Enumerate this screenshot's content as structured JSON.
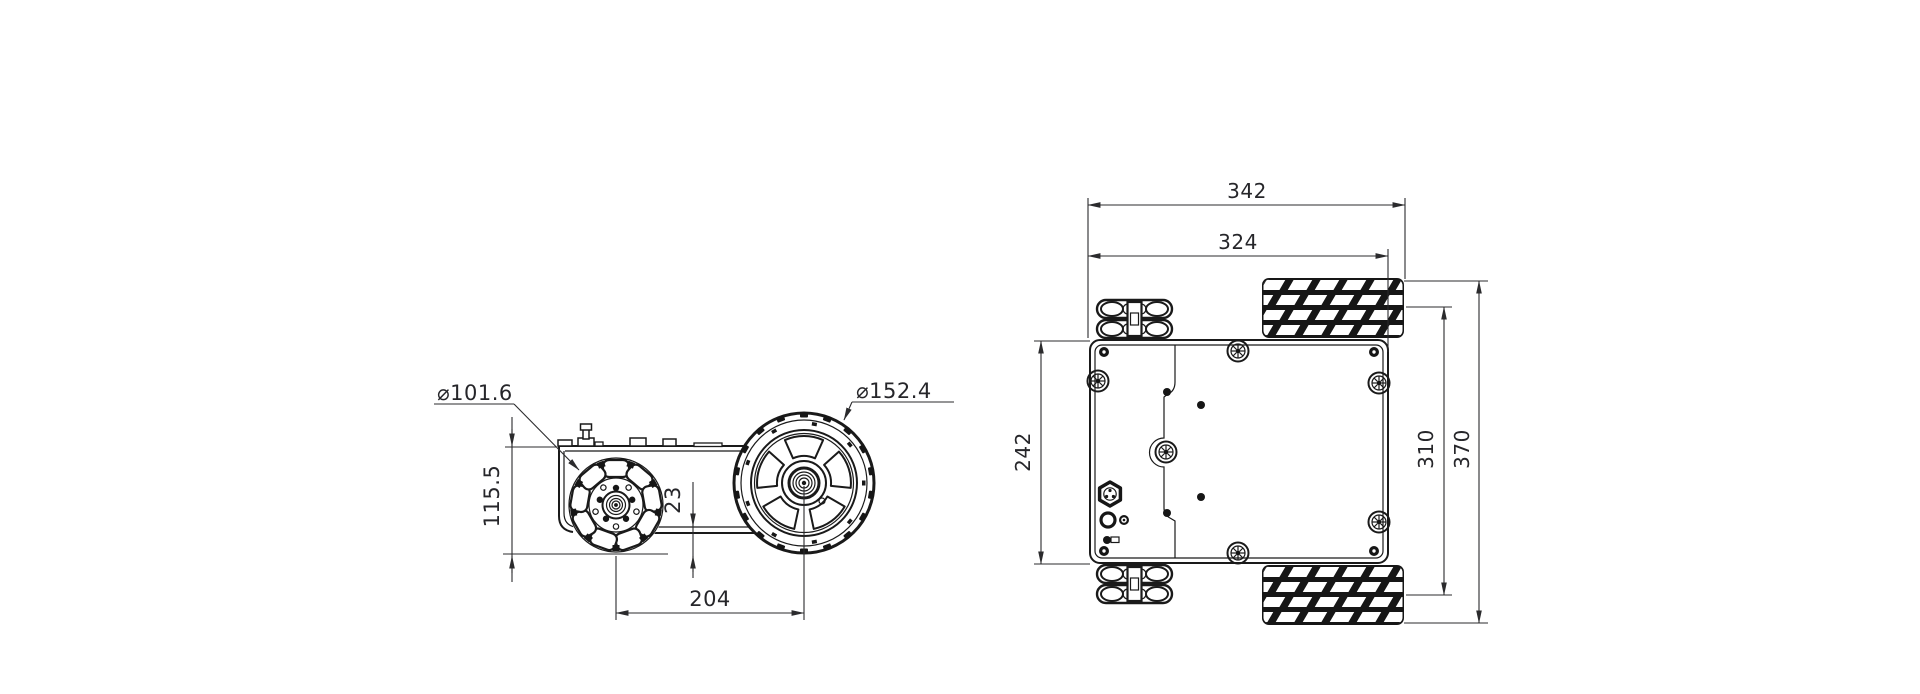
{
  "drawing": {
    "colors": {
      "line": "#1a1a1a",
      "dimension": "#2b2b2d",
      "background": "#ffffff"
    },
    "side_view": {
      "dimensions": {
        "omni_wheel_diameter": "⌀101.6",
        "drive_wheel_diameter": "⌀152.4",
        "overall_height": "115.5",
        "ground_clearance": "23",
        "wheelbase": "204"
      }
    },
    "top_view": {
      "dimensions": {
        "overall_length": "342",
        "inner_length": "324",
        "chassis_width": "242",
        "track_width": "310",
        "overall_width": "370"
      }
    }
  }
}
